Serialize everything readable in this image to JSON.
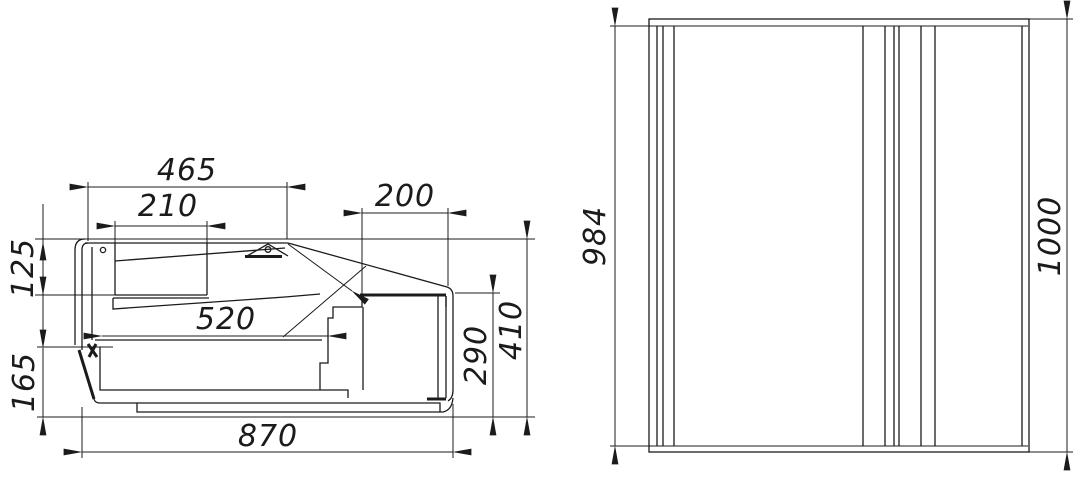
{
  "page": {
    "background": "#ffffff",
    "line_color": "#1b1b1b",
    "title": "Technical dimension drawing, two views"
  },
  "drawing": {
    "side_section_view": {
      "label": "side-section",
      "dimensions": {
        "top_width": "465",
        "duct_width": "210",
        "condenser_width": "200",
        "canopy_height": "125",
        "well_depth": "520",
        "compartment_height": "290",
        "back_height": "410",
        "base_height": "165",
        "overall_depth": "870"
      }
    },
    "front_view": {
      "label": "front",
      "dimensions": {
        "inner_height": "984",
        "overall_height": "1000"
      }
    }
  }
}
